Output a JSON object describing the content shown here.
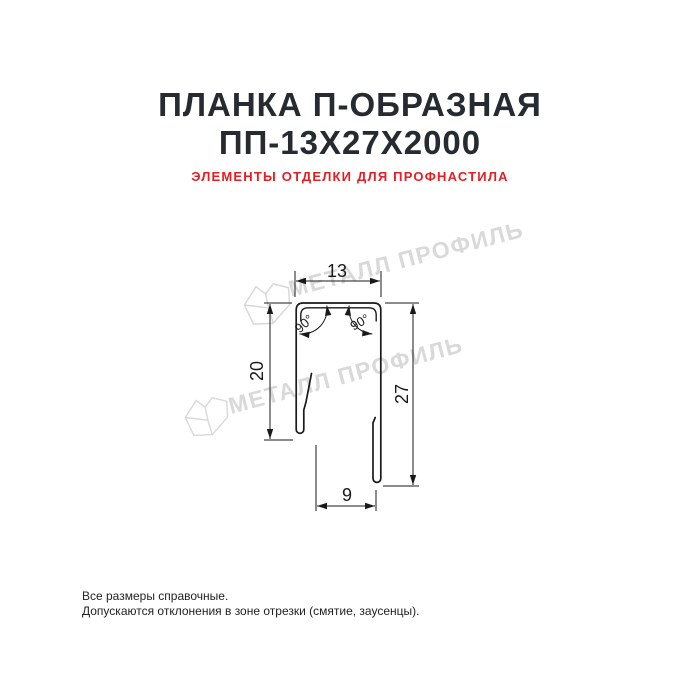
{
  "header": {
    "title_line1": "ПЛАНКА П-ОБРАЗНАЯ",
    "title_line2": "ПП-13Х27Х2000",
    "subtitle": "ЭЛЕМЕНТЫ ОТДЕЛКИ ДЛЯ ПРОФНАСТИЛА"
  },
  "drawing": {
    "type": "technical-cross-section",
    "product": "U-shaped strip profile",
    "dimensions": {
      "top_width": "13",
      "left_height": "20",
      "right_height": "27",
      "bottom_width": "9",
      "angle_left": "90°",
      "angle_right": "90°"
    }
  },
  "watermark": {
    "text": "МЕТАЛЛ ПРОФИЛЬ"
  },
  "footer": {
    "line1": "Все размеры справочные.",
    "line2": "Допускаются отклонения в зоне отрезки (смятие, заусенцы)."
  },
  "colors": {
    "title": "#262a31",
    "subtitle": "#e31e24",
    "line": "#1a1a1a",
    "watermark": "#d9d9d9",
    "background": "#ffffff"
  }
}
